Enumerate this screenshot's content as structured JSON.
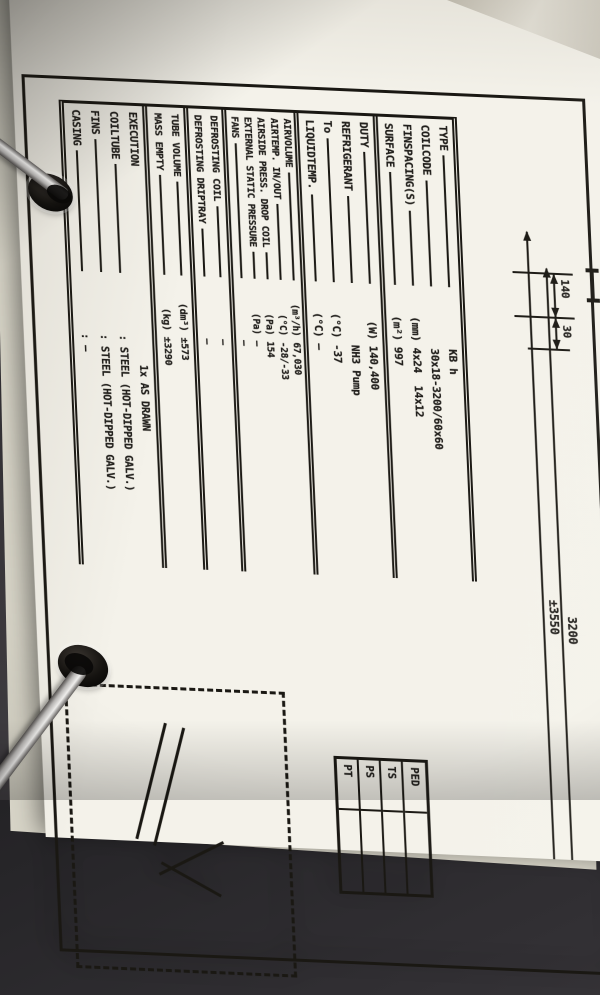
{
  "spec_table": {
    "sections": [
      {
        "rows": [
          {
            "label": "TYPE",
            "unit": "",
            "value": "KB h"
          },
          {
            "label": "COILCODE",
            "unit": "",
            "value": "30x18-3200/60x60"
          },
          {
            "label": "FINSPACING(S)",
            "unit": "(mm)",
            "value": "4x24  14x12"
          },
          {
            "label": "SURFACE",
            "unit": "(m²)",
            "value": "997"
          }
        ]
      },
      {
        "rows": [
          {
            "label": "DUTY",
            "unit": "(W)",
            "value": "140,400"
          },
          {
            "label": "REFRIGERANT",
            "unit": "",
            "value": "NH3 Pump"
          },
          {
            "label": "To",
            "unit": "(°C)",
            "value": "-37"
          },
          {
            "label": "LIQUIDTEMP.",
            "unit": "(°C)",
            "value": "—"
          }
        ]
      },
      {
        "rows": [
          {
            "label": "AIRVOLUME",
            "unit": "(m³/h)",
            "value": "67,030"
          },
          {
            "label": "AIRTEMP. IN/OUT",
            "unit": "(°C)",
            "value": "-28/-33"
          },
          {
            "label": "AIRSIDE PRESS. DROP COIL",
            "unit": "(Pa)",
            "value": "154"
          },
          {
            "label": "EXTERNAL STATIC PRESSURE",
            "unit": "(Pa)",
            "value": "—"
          },
          {
            "label": "FANS",
            "unit": "",
            "value": "—"
          }
        ]
      },
      {
        "rows": [
          {
            "label": "DEFROSTING COIL",
            "unit": "",
            "value": "—"
          },
          {
            "label": "DEFROSTING DRIPTRAY",
            "unit": "",
            "value": "—"
          }
        ]
      },
      {
        "rows": [
          {
            "label": "TUBE VOLUME",
            "unit": "(dm³)",
            "value": "±573"
          },
          {
            "label": "MASS EMPTY",
            "unit": "(kg)",
            "value": "±3290"
          }
        ]
      },
      {
        "rows": [
          {
            "label": "EXECUTION",
            "unit": "",
            "value": "1x AS DRAWN"
          },
          {
            "label": "COILTUBE",
            "unit": "",
            "value": ": STEEL (HOT-DIPPED GALV.)"
          },
          {
            "label": "FINS",
            "unit": "",
            "value": ": STEEL (HOT-DIPPED GALV.)"
          },
          {
            "label": "CASING",
            "unit": "",
            "value": ": —"
          }
        ]
      }
    ]
  },
  "dimensions": {
    "d140": "140",
    "d30": "30",
    "d3200": "3200",
    "d3550": "±3550"
  },
  "ped_table": {
    "header": "PED",
    "rows": [
      "TS",
      "PS",
      "PT"
    ]
  },
  "colors": {
    "paper": "#f4f2ea",
    "ink": "#1a1813",
    "background": "#312f33",
    "metal_ring": "#c9c7c5"
  }
}
